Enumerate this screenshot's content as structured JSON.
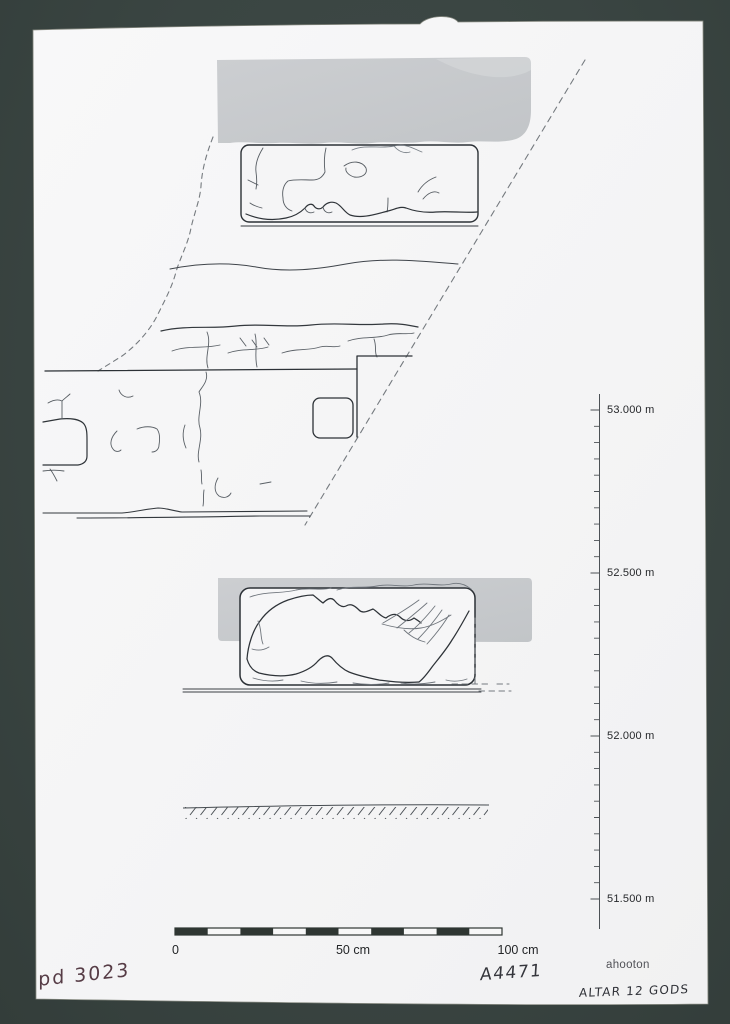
{
  "sheet": {
    "title_handwritten": "ALTAR 12 GODS",
    "catalog_number_handwritten": "pd 3023",
    "inventory_number_handwritten": "A4471",
    "author_printed": "ahooton"
  },
  "elevation_scale": {
    "unit": "m",
    "labels": [
      {
        "text": "53.000 m",
        "value": 53.0
      },
      {
        "text": "52.500 m",
        "value": 52.5
      },
      {
        "text": "52.000 m",
        "value": 52.0
      },
      {
        "text": "51.500 m",
        "value": 51.5
      }
    ]
  },
  "scale_bar": {
    "labels": [
      "0",
      "50 cm",
      "100 cm"
    ],
    "total_cm": 100,
    "segments": 10
  },
  "colors": {
    "mat_background": "#3a4542",
    "paper": "#f5f5f6",
    "tone_band": "#c6c8cb",
    "ink_line": "#2e3338",
    "handwriting_ink": "#563c46",
    "pencil_ink": "#35363c"
  }
}
